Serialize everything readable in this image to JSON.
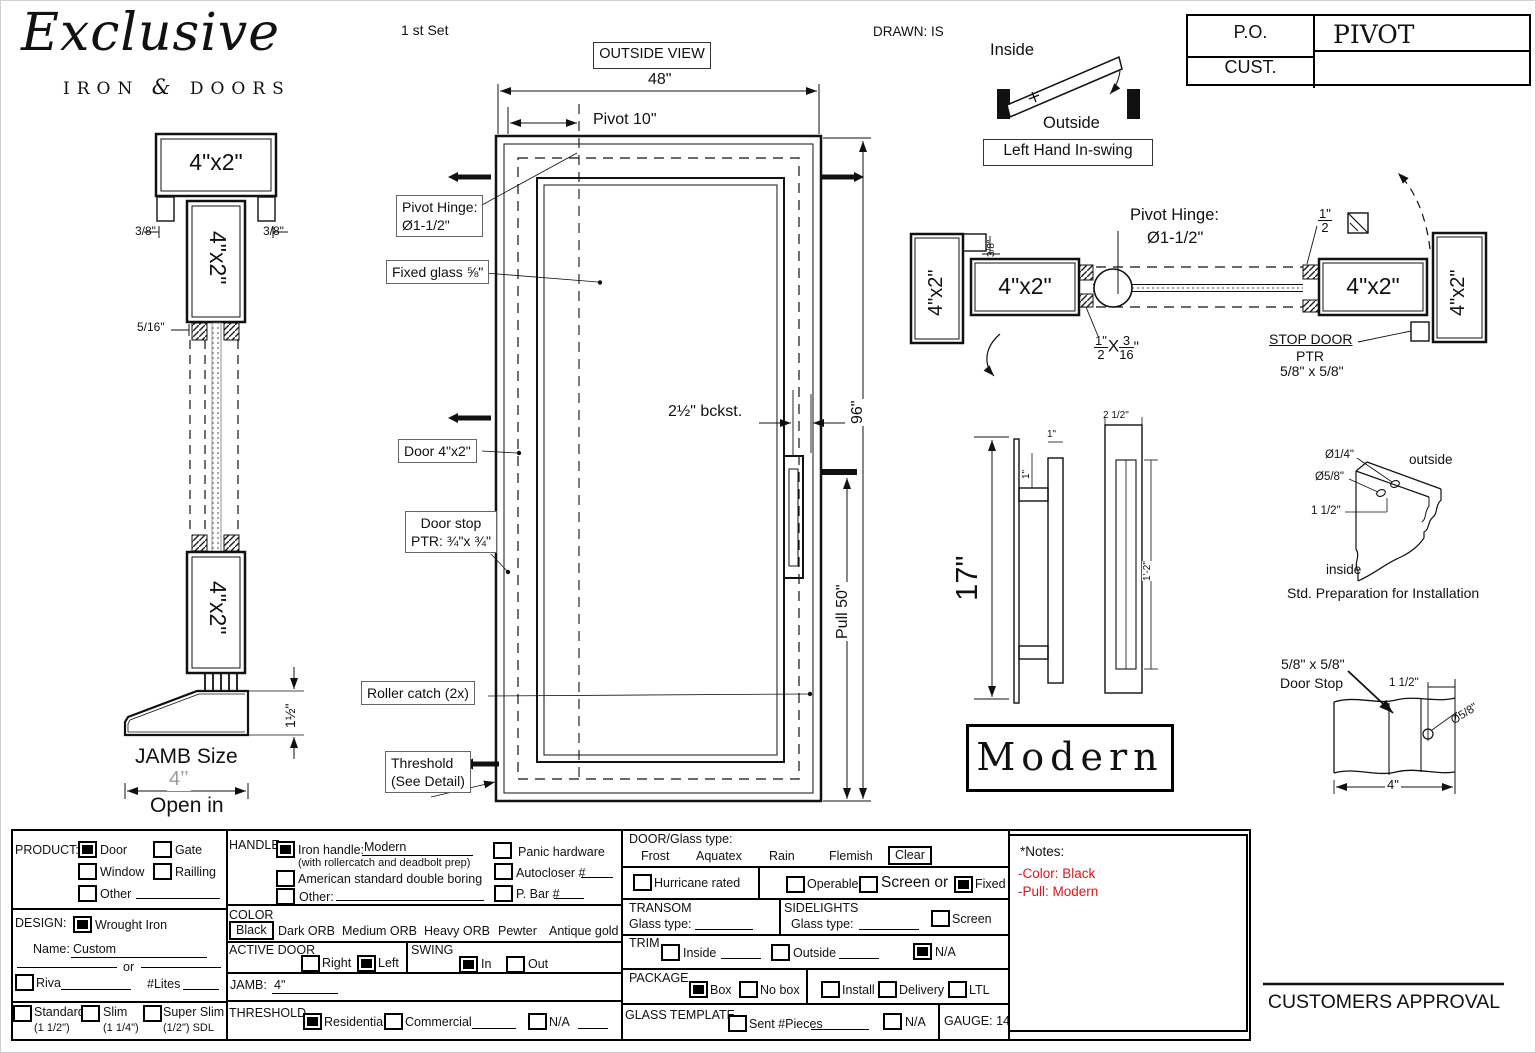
{
  "logo": {
    "title": "Exclusive",
    "word1": "IRON",
    "amp": "&",
    "word2": "DOORS"
  },
  "header": {
    "set": "1 st Set",
    "view": "OUTSIDE VIEW",
    "drawn": "DRAWN: IS"
  },
  "title_block": {
    "po_label": "P.O.",
    "po_value": "PIVOT",
    "cust_label": "CUST.",
    "cust_value": ""
  },
  "swing_diagram": {
    "inside": "Inside",
    "outside": "Outside",
    "caption": "Left Hand In-swing",
    "plus": "+"
  },
  "jamb_view": {
    "top_size": "4\"x2\"",
    "dim_left": "3/8\"",
    "dim_right": "3/8\"",
    "mid_size": "4\"x2\"",
    "dim_glass": "5/16\"",
    "bottom_size": "4\"x2\"",
    "dim_threshold": "1½\"",
    "jamb_label": "JAMB Size",
    "jamb_dim": "4’’",
    "open_label": "Open in"
  },
  "elevation": {
    "width_dim": "48\"",
    "pivot_dim": "Pivot 10\"",
    "height_dim": "96\"",
    "pull_dim": "Pull 50\"",
    "backset_dim": "2½\" bckst.",
    "pivot_hinge_line1": "Pivot Hinge:",
    "pivot_hinge_line2": "Ø1-1/2\"",
    "fixed_glass": "Fixed glass ⅝\"",
    "door_label": "Door 4\"x2\"",
    "door_stop_line1": "Door stop",
    "door_stop_line2": "PTR: ¾\"x ¾\"",
    "roller_catch": "Roller catch  (2x)",
    "threshold_line1": "Threshold",
    "threshold_line2": "(See Detail)"
  },
  "plan_view": {
    "jamb_left": "4\"x2\"",
    "dim_38": "3/8\"",
    "door_left": "4\"x2\"",
    "hinge_line1": "Pivot Hinge:",
    "hinge_line2": "Ø1-1/2\"",
    "gap_frac": {
      "n": "1\"",
      "d": "2"
    },
    "ptr_frac": {
      "n1": "1\"",
      "d1": "2",
      "mid": "X",
      "n2": "3",
      "d2": "16",
      "q": "\""
    },
    "door_right": "4\"x2\"",
    "jamb_right": "4\"x2\"",
    "stop_line1": "STOP DOOR",
    "stop_line2": "PTR",
    "stop_line3": "5/8\" x 5/8\""
  },
  "pull_detail": {
    "height": "17\"",
    "offset_side": "1\"",
    "offset_top": "1\"",
    "width": "2 1/2\"",
    "length": "1'-2\"",
    "style_name": "Modern"
  },
  "prep_detail": {
    "hole_small": "Ø1/4\"",
    "hole_big": "Ø5/8\"",
    "offset": "1 1/2\"",
    "outside": "outside",
    "inside": "inside",
    "caption": "Std. Preparation for Installation"
  },
  "stop_detail": {
    "label1": "5/8\" x 5/8\"",
    "label2": "Door Stop",
    "dim_offset": "1 1/2\"",
    "dim_hole": "Ø5/8\"",
    "dim_width": "4\""
  },
  "form": {
    "product": {
      "label": "PRODUCT:",
      "door": {
        "label": "Door",
        "checked": true
      },
      "gate": {
        "label": "Gate",
        "checked": false
      },
      "window": {
        "label": "Window",
        "checked": false
      },
      "railling": {
        "label": "Railling",
        "checked": false
      },
      "other": {
        "label": "Other",
        "checked": false
      }
    },
    "design": {
      "label": "DESIGN:",
      "wrought_iron": {
        "label": "Wrought Iron",
        "checked": true
      },
      "name_label": "Name:",
      "name_value": "Custom",
      "or_label": "or",
      "riva": {
        "label": "Riva",
        "checked": false
      },
      "lites_label": "#Lites"
    },
    "frame_type": {
      "standard": {
        "label": "Standard",
        "sub": "(1 1/2\")",
        "checked": false
      },
      "slim": {
        "label": "Slim",
        "sub": "(1 1/4\")",
        "checked": false
      },
      "super_slim": {
        "label": "Super Slim",
        "sub": "(1/2\") SDL",
        "checked": false
      }
    },
    "handle": {
      "label": "HANDLE",
      "iron_handle": {
        "label": "Iron handle:",
        "value": "Modern",
        "note": "(with rollercatch and deadbolt prep)",
        "checked": true
      },
      "american": {
        "label": "American standard double boring",
        "checked": false
      },
      "other": {
        "label": "Other:",
        "checked": false
      },
      "panic": {
        "label": "Panic hardware",
        "checked": false
      },
      "autocloser": {
        "label": "Autocloser #",
        "checked": false
      },
      "pbar": {
        "label": "P. Bar #",
        "checked": false
      }
    },
    "color": {
      "label": "COLOR",
      "selected": "Black",
      "opt1": "Dark ORB",
      "opt2": "Medium ORB",
      "opt3": "Heavy ORB",
      "opt4": "Pewter",
      "opt5": "Antique gold"
    },
    "active_door": {
      "label": "ACTIVE DOOR",
      "right": {
        "label": "Right",
        "checked": false
      },
      "left": {
        "label": "Left",
        "checked": true
      }
    },
    "swing": {
      "label": "SWING",
      "in": {
        "label": "In",
        "checked": true
      },
      "out": {
        "label": "Out",
        "checked": false
      }
    },
    "jamb": {
      "label": "JAMB:",
      "value": "4\""
    },
    "threshold": {
      "label": "THRESHOLD",
      "residential": {
        "label": "Residential",
        "checked": true
      },
      "commercial": {
        "label": "Commercial",
        "checked": false
      },
      "na": {
        "label": "N/A",
        "checked": false
      }
    },
    "glass_type": {
      "label": "DOOR/Glass type:",
      "opt1": "Frost",
      "opt2": "Aquatex",
      "opt3": "Rain",
      "opt4": "Flemish",
      "selected": "Clear"
    },
    "hurricane": {
      "label": "Hurricane rated",
      "checked": false
    },
    "glazing": {
      "operable": {
        "label": "Operable",
        "checked": false
      },
      "screen": {
        "label": "Screen or",
        "checked": false
      },
      "fixed": {
        "label": "Fixed",
        "checked": true
      }
    },
    "transom": {
      "label": "TRANSOM",
      "glass_label": "Glass type:"
    },
    "sidelights": {
      "label": "SIDELIGHTS",
      "glass_label": "Glass type:",
      "screen": {
        "label": "Screen",
        "checked": false
      }
    },
    "trim": {
      "label": "TRIM",
      "inside": {
        "label": "Inside",
        "checked": false
      },
      "outside": {
        "label": "Outside",
        "checked": false
      },
      "na": {
        "label": "N/A",
        "checked": true
      }
    },
    "package": {
      "label": "PACKAGE",
      "box": {
        "label": "Box",
        "checked": true
      },
      "no_box": {
        "label": "No box",
        "checked": false
      },
      "install": {
        "label": "Install",
        "checked": false
      },
      "delivery": {
        "label": "Delivery",
        "checked": false
      },
      "ltl": {
        "label": "LTL",
        "checked": false
      }
    },
    "glass_template": {
      "label": "GLASS TEMPLATE",
      "sent": {
        "label": "Sent #Pieces",
        "checked": false
      },
      "na": {
        "label": "N/A",
        "checked": false
      }
    },
    "gauge": {
      "label": "GAUGE: 14"
    },
    "notes": {
      "label": "*Notes:",
      "line1": "-Color: Black",
      "line2": "-Pull: Modern",
      "color": "#e01515"
    }
  },
  "approval": "CUSTOMERS APPROVAL"
}
